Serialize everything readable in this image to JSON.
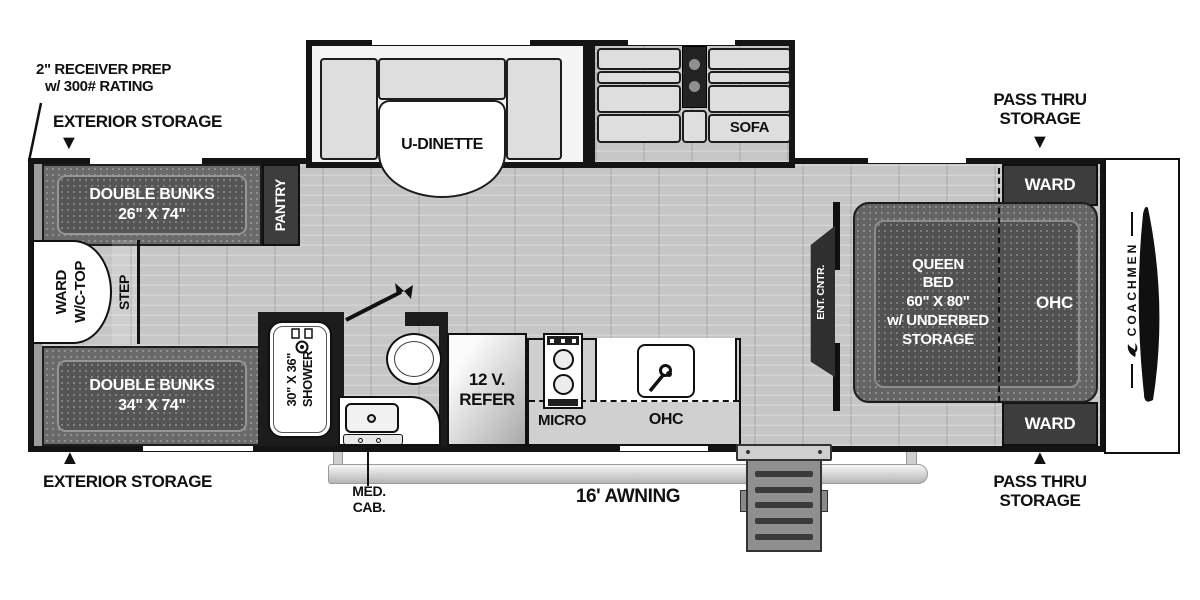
{
  "brand": "COACHMEN",
  "icons": {
    "arrow_down": "▼",
    "arrow_up": "▲",
    "dove_logo": "coachmen-dove",
    "shower_head": "shower-head",
    "faucet": "faucet",
    "burners": "stove-burners"
  },
  "colors": {
    "wall": "#141414",
    "floor": "#c6c6c6",
    "furniture_dark": "#3d3d3d",
    "bed_outer": "#646464",
    "bed_inner": "#515151",
    "cushion": "#dedede",
    "white": "#ffffff"
  },
  "callouts": {
    "receiver_prep": {
      "line1": "2\" RECEIVER PREP",
      "line2": "w/ 300# RATING"
    },
    "exterior_storage": "EXTERIOR STORAGE",
    "pass_thru": {
      "line1": "PASS THRU",
      "line2": "STORAGE"
    },
    "med_cab": {
      "line1": "MED.",
      "line2": "CAB."
    },
    "awning": "16' AWNING"
  },
  "rooms": {
    "bunk_top": {
      "line1": "DOUBLE BUNKS",
      "line2": "26\" X 74\""
    },
    "bunk_bottom": {
      "line1": "DOUBLE BUNKS",
      "line2": "34\" X 74\""
    },
    "ward_wc_top": {
      "line1": "WARD",
      "line2": "W/C-TOP"
    },
    "step": "STEP",
    "pantry": "PANTRY",
    "u_dinette": "U-DINETTE",
    "sofa": "SOFA",
    "shower": {
      "line1": "30\" X 36\"",
      "line2": "SHOWER"
    },
    "refer": {
      "line1": "12 V.",
      "line2": "REFER"
    },
    "micro": "MICRO",
    "ohc_kitchen": "OHC",
    "ent_cntr": "ENT. CNTR.",
    "queen_bed": {
      "line1": "QUEEN",
      "line2": "BED",
      "line3": "60\" X 80\"",
      "line4": "w/ UNDERBED",
      "line5": "STORAGE"
    },
    "ohc_bedroom": "OHC",
    "ward": "WARD"
  }
}
